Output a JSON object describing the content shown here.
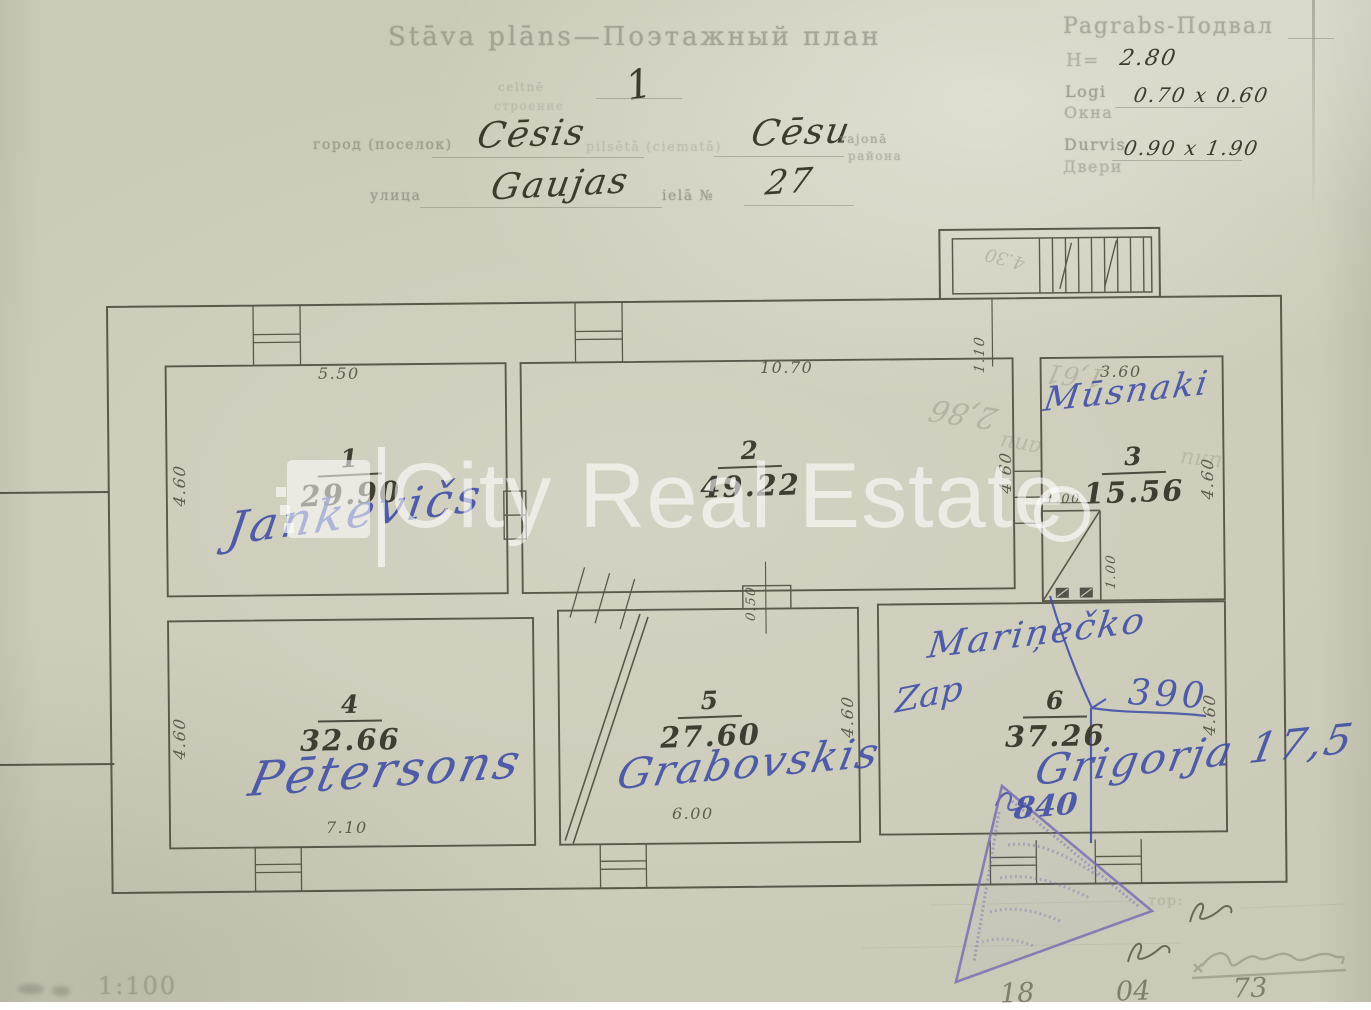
{
  "page": {
    "title": "Stāva plāns—Поэтажный план",
    "sheet_no": "1",
    "sub_lv": "celtnē",
    "sub_ru": "строение",
    "city_label": "город (поселок)",
    "city": "Cēsis",
    "mid_faint": "pilsētā (ciematā)",
    "district": "Cēsu",
    "district_lbl1": "rajonā",
    "district_lbl2": "района",
    "street_label": "улица",
    "street": "Gaujas",
    "street_lbl2": "ielā №",
    "house": "27"
  },
  "info": {
    "title": "Pagrabs-Подвал",
    "h_label": "H=",
    "h_value": "2.80",
    "logi": "Logi",
    "okna": "Окна",
    "windows_value": "0.70 x 0.60",
    "durvis": "Durvis",
    "dveri": "Двери",
    "doors_value": "0.90 x 1.90"
  },
  "watermark": {
    "text": "City Real Estate"
  },
  "rooms": [
    {
      "num": "1",
      "area": "29.90",
      "owner": "Jankevičs"
    },
    {
      "num": "2",
      "area": "49.22",
      "owner": ""
    },
    {
      "num": "3",
      "area": "15.56",
      "owner": "Mūsnaki"
    },
    {
      "num": "4",
      "area": "32.66",
      "owner": "Pētersons"
    },
    {
      "num": "5",
      "area": "27.60",
      "owner": "Grabovskis"
    },
    {
      "num": "6",
      "area": "37.26",
      "owner": "Mariņečko"
    }
  ],
  "dims": {
    "r1_top": "5.50",
    "r1_left": "4.60",
    "r2_top": "10.70",
    "r2_right": "4.60",
    "r3_top": "3.60",
    "r3_right": "4.60",
    "stair_w": "1.00",
    "stair_h": "1.00",
    "r4_left": "4.60",
    "r4_bottom": "7.10",
    "notch": "0.50",
    "r5_bottom": "6.00",
    "r5_right": "4.60",
    "r6_right": "4.60",
    "landing": "1.10",
    "pencil_stair": "4.30"
  },
  "blue_notes": {
    "zap": "Zap",
    "len": "390",
    "grig": "Grigorja 17,5",
    "num": "840"
  },
  "pencil_notes": {
    "a": "2,86",
    "b": "1,61",
    "c": "апи",
    "d": "или"
  },
  "footer": {
    "scale": "1:100",
    "frag": "тор:",
    "day": "18",
    "month": "04",
    "year": "73"
  }
}
